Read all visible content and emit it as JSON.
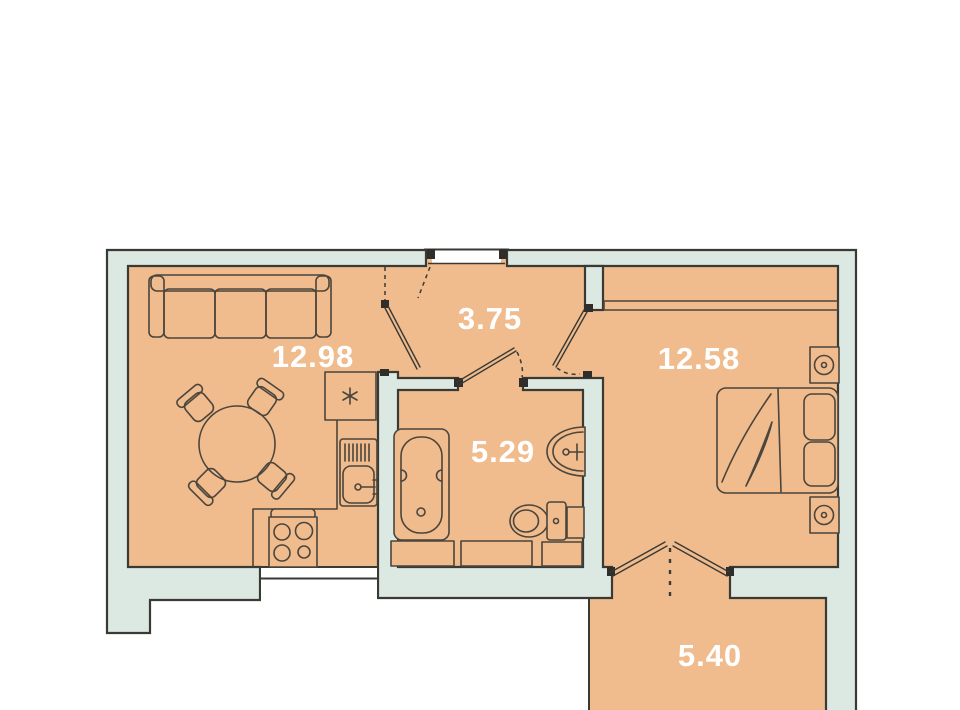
{
  "plan": {
    "type": "apartment-floor-plan",
    "units": "m2",
    "rooms": [
      {
        "id": "living-kitchen",
        "area_label": "12.98"
      },
      {
        "id": "hallway",
        "area_label": "3.75"
      },
      {
        "id": "bathroom",
        "area_label": "5.29"
      },
      {
        "id": "bedroom",
        "area_label": "12.58"
      },
      {
        "id": "balcony",
        "area_label": "5.40"
      }
    ],
    "colors": {
      "floor": "#f0bc8e",
      "wall": "#dbe9e2",
      "outline": "#3a3934",
      "furniture_line": "#4b453c",
      "label_text": "#ffffff",
      "background": "#ffffff"
    },
    "furniture_icons": [
      "sofa-icon",
      "dining-table-icon",
      "chair-icon",
      "fridge-icon",
      "kitchen-sink-icon",
      "stove-icon",
      "bathtub-icon",
      "washbasin-icon",
      "toilet-icon",
      "washing-machine-icon",
      "double-bed-icon",
      "nightstand-icon",
      "wardrobe-icon",
      "door-swing-icon"
    ]
  }
}
